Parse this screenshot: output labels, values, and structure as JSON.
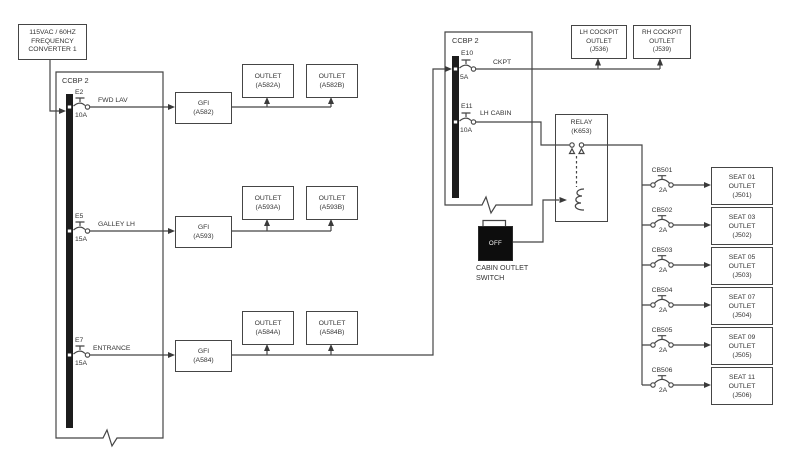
{
  "diagram": {
    "source_label": "115VAC / 60HZ\nFREQUENCY\nCONVERTER 1",
    "left_panel": {
      "title": "CCBP 2",
      "breakers": [
        {
          "id": "E2",
          "rating": "10A",
          "circuit": "FWD LAV"
        },
        {
          "id": "E5",
          "rating": "15A",
          "circuit": "GALLEY LH"
        },
        {
          "id": "E7",
          "rating": "15A",
          "circuit": "ENTRANCE"
        }
      ]
    },
    "gfi": [
      {
        "label": "GFI\n(A582)"
      },
      {
        "label": "GFI\n(A593)"
      },
      {
        "label": "GFI\n(A584)"
      }
    ],
    "outlets": [
      {
        "label": "OUTLET\n(A582A)"
      },
      {
        "label": "OUTLET\n(A582B)"
      },
      {
        "label": "OUTLET\n(A593A)"
      },
      {
        "label": "OUTLET\n(A593B)"
      },
      {
        "label": "OUTLET\n(A584A)"
      },
      {
        "label": "OUTLET\n(A584B)"
      }
    ],
    "right_panel": {
      "title": "CCBP 2",
      "breakers": [
        {
          "id": "E10",
          "rating": "5A",
          "circuit": "CKPT"
        },
        {
          "id": "E11",
          "rating": "10A",
          "circuit": "LH CABIN"
        }
      ]
    },
    "cockpit_outlets": [
      {
        "label": "LH COCKPIT\nOUTLET\n(J536)"
      },
      {
        "label": "RH COCKPIT\nOUTLET\n(J539)"
      }
    ],
    "relay_label": "RELAY\n(K653)",
    "cabin_switch": {
      "state": "OFF",
      "label": "CABIN OUTLET\nSWITCH"
    },
    "seat_rows": [
      {
        "cb": "CB501",
        "rating": "2A",
        "outlet": "SEAT 01\nOUTLET\n(J501)"
      },
      {
        "cb": "CB502",
        "rating": "2A",
        "outlet": "SEAT 03\nOUTLET\n(J502)"
      },
      {
        "cb": "CB503",
        "rating": "2A",
        "outlet": "SEAT 05\nOUTLET\n(J503)"
      },
      {
        "cb": "CB504",
        "rating": "2A",
        "outlet": "SEAT 07\nOUTLET\n(J504)"
      },
      {
        "cb": "CB505",
        "rating": "2A",
        "outlet": "SEAT 09\nOUTLET\n(J505)"
      },
      {
        "cb": "CB506",
        "rating": "2A",
        "outlet": "SEAT 11\nOUTLET\n(J506)"
      }
    ],
    "colors": {
      "line": "#454545",
      "bus": "#1c1c1c",
      "text": "#333333",
      "switch_bg": "#0d0d0d",
      "switch_text": "#ffffff",
      "bg": "#ffffff"
    }
  }
}
